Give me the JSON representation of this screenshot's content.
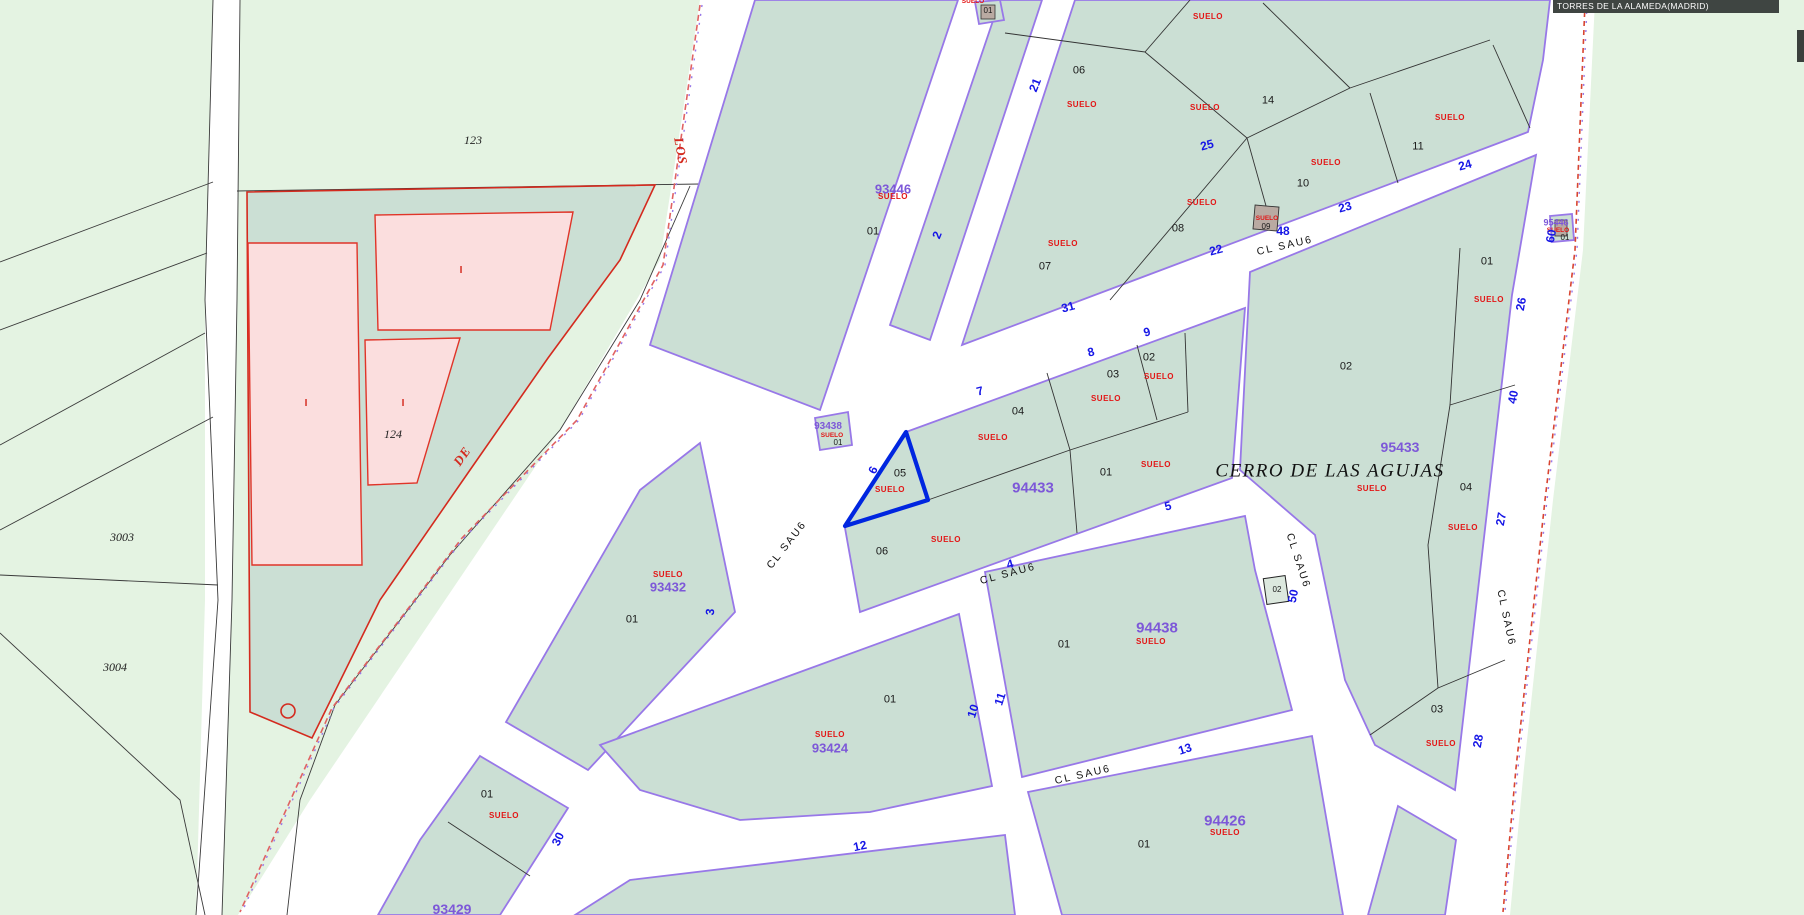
{
  "title_bar": {
    "text": "TORRES DE LA ALAMEDA(MADRID)"
  },
  "map": {
    "place_name": {
      "text": "CERRO DE LAS AGUJAS",
      "x": 1330,
      "y": 471
    },
    "land_use": {
      "text": "SUELO",
      "positions": [
        [
          1208,
          17,
          0
        ],
        [
          1082,
          105,
          0
        ],
        [
          1205,
          108,
          0
        ],
        [
          1450,
          118,
          0
        ],
        [
          1326,
          163,
          0
        ],
        [
          1202,
          203,
          0
        ],
        [
          1063,
          244,
          0
        ],
        [
          1489,
          300,
          0
        ],
        [
          893,
          197,
          0
        ],
        [
          1267,
          219,
          1
        ],
        [
          1159,
          377,
          0
        ],
        [
          1106,
          399,
          0
        ],
        [
          993,
          438,
          0
        ],
        [
          1156,
          465,
          0
        ],
        [
          890,
          490,
          0
        ],
        [
          946,
          540,
          0
        ],
        [
          1372,
          489,
          0
        ],
        [
          1463,
          528,
          0
        ],
        [
          1441,
          744,
          0
        ],
        [
          668,
          575,
          0
        ],
        [
          830,
          735,
          0
        ],
        [
          1151,
          642,
          0
        ],
        [
          1225,
          833,
          0
        ],
        [
          504,
          816,
          0
        ],
        [
          832,
          436,
          1
        ],
        [
          1558,
          231,
          1
        ],
        [
          973,
          2,
          1
        ]
      ]
    },
    "parcel_numbers": [
      [
        "01",
        988,
        11,
        1
      ],
      [
        "06",
        1079,
        71,
        0
      ],
      [
        "07",
        1045,
        267,
        0
      ],
      [
        "08",
        1178,
        229,
        0
      ],
      [
        "14",
        1268,
        101,
        0
      ],
      [
        "10",
        1303,
        184,
        0
      ],
      [
        "11",
        1418,
        147,
        0
      ],
      [
        "09",
        1266,
        227,
        1
      ],
      [
        "01",
        873,
        232,
        0
      ],
      [
        "02",
        1149,
        358,
        0
      ],
      [
        "03",
        1113,
        375,
        0
      ],
      [
        "04",
        1018,
        412,
        0
      ],
      [
        "05",
        900,
        474,
        0
      ],
      [
        "01",
        1106,
        473,
        0
      ],
      [
        "06",
        882,
        552,
        0
      ],
      [
        "02",
        1346,
        367,
        0
      ],
      [
        "01",
        1487,
        262,
        0
      ],
      [
        "04",
        1466,
        488,
        0
      ],
      [
        "03",
        1437,
        710,
        0
      ],
      [
        "01",
        632,
        620,
        0
      ],
      [
        "01",
        890,
        700,
        0
      ],
      [
        "01",
        1064,
        645,
        0
      ],
      [
        "02",
        1277,
        590,
        1
      ],
      [
        "01",
        487,
        795,
        0
      ],
      [
        "01",
        1144,
        845,
        0
      ],
      [
        "01",
        838,
        443,
        1
      ],
      [
        "01",
        1565,
        238,
        1
      ]
    ],
    "block_numbers": [
      [
        "93446",
        893,
        189,
        13
      ],
      [
        "93432",
        668,
        587,
        13
      ],
      [
        "93424",
        830,
        748,
        13
      ],
      [
        "94433",
        1033,
        488,
        15
      ],
      [
        "94438",
        1157,
        628,
        15
      ],
      [
        "94426",
        1225,
        821,
        15
      ],
      [
        "95433",
        1400,
        447,
        14
      ],
      [
        "93429",
        452,
        909,
        14
      ],
      [
        "93438",
        828,
        427,
        10
      ],
      [
        "95446",
        1556,
        223,
        9
      ]
    ],
    "street_numbers": [
      [
        "31",
        1068,
        307,
        -15
      ],
      [
        "22",
        1216,
        250,
        -15
      ],
      [
        "23",
        1345,
        207,
        -15
      ],
      [
        "24",
        1465,
        165,
        -15
      ],
      [
        "25",
        1207,
        145,
        -15
      ],
      [
        "48",
        1283,
        231,
        0
      ],
      [
        "8",
        1091,
        352,
        -15
      ],
      [
        "9",
        1147,
        332,
        -15
      ],
      [
        "7",
        980,
        391,
        -15
      ],
      [
        "5",
        1168,
        506,
        -15
      ],
      [
        "4",
        1010,
        564,
        -15
      ],
      [
        "12",
        860,
        846,
        -12
      ],
      [
        "13",
        1185,
        749,
        -18
      ],
      [
        "21",
        1035,
        85,
        -68
      ],
      [
        "2",
        937,
        235,
        -68
      ],
      [
        "6",
        873,
        470,
        -65
      ],
      [
        "3",
        710,
        612,
        -85
      ],
      [
        "10",
        973,
        711,
        -72
      ],
      [
        "11",
        1000,
        699,
        -72
      ],
      [
        "30",
        558,
        839,
        -65
      ],
      [
        "26",
        1521,
        304,
        -80
      ],
      [
        "40",
        1513,
        397,
        -80
      ],
      [
        "27",
        1501,
        519,
        -80
      ],
      [
        "28",
        1478,
        741,
        -80
      ],
      [
        "50",
        1293,
        596,
        -78
      ],
      [
        "60",
        1551,
        236,
        -80
      ]
    ],
    "street_names": [
      [
        "CL SAU6",
        1285,
        246,
        -13
      ],
      [
        "CL SAU6",
        787,
        545,
        -52
      ],
      [
        "CL SAU6",
        1008,
        574,
        -15
      ],
      [
        "CL SAU6",
        1083,
        775,
        -13
      ],
      [
        "CL SAU6",
        1298,
        561,
        72
      ],
      [
        "CL SAU6",
        1506,
        618,
        78
      ]
    ],
    "road_names_red": [
      [
        "LOS",
        681,
        151,
        80
      ],
      [
        "DE",
        462,
        456,
        -55
      ]
    ],
    "rustic_parcel_numbers": [
      [
        "123",
        473,
        140
      ],
      [
        "124",
        393,
        434
      ],
      [
        "3003",
        122,
        537
      ],
      [
        "3004",
        115,
        667
      ]
    ],
    "building_marks": {
      "text": "I",
      "positions": [
        [
          461,
          271
        ],
        [
          306,
          404
        ],
        [
          403,
          404
        ]
      ]
    },
    "selected_parcel": {
      "number": "05",
      "land_use": "SUELO",
      "outline_color": "#0026e0"
    },
    "colors": {
      "urban_block": "#cbdfd4",
      "street": "#ffffff",
      "rustic": "#e4f3e2",
      "block_boundary": "#9878e8",
      "building_fill": "#fbdede",
      "building_stroke": "#e03428",
      "land_use_text": "#e31515",
      "block_number_text": "#7d58d8",
      "street_number_text": "#1515e6",
      "selected_outline": "#0026e0",
      "title_bar_bg": "#3f4542",
      "rustic_line": "#3a3a3a"
    }
  }
}
